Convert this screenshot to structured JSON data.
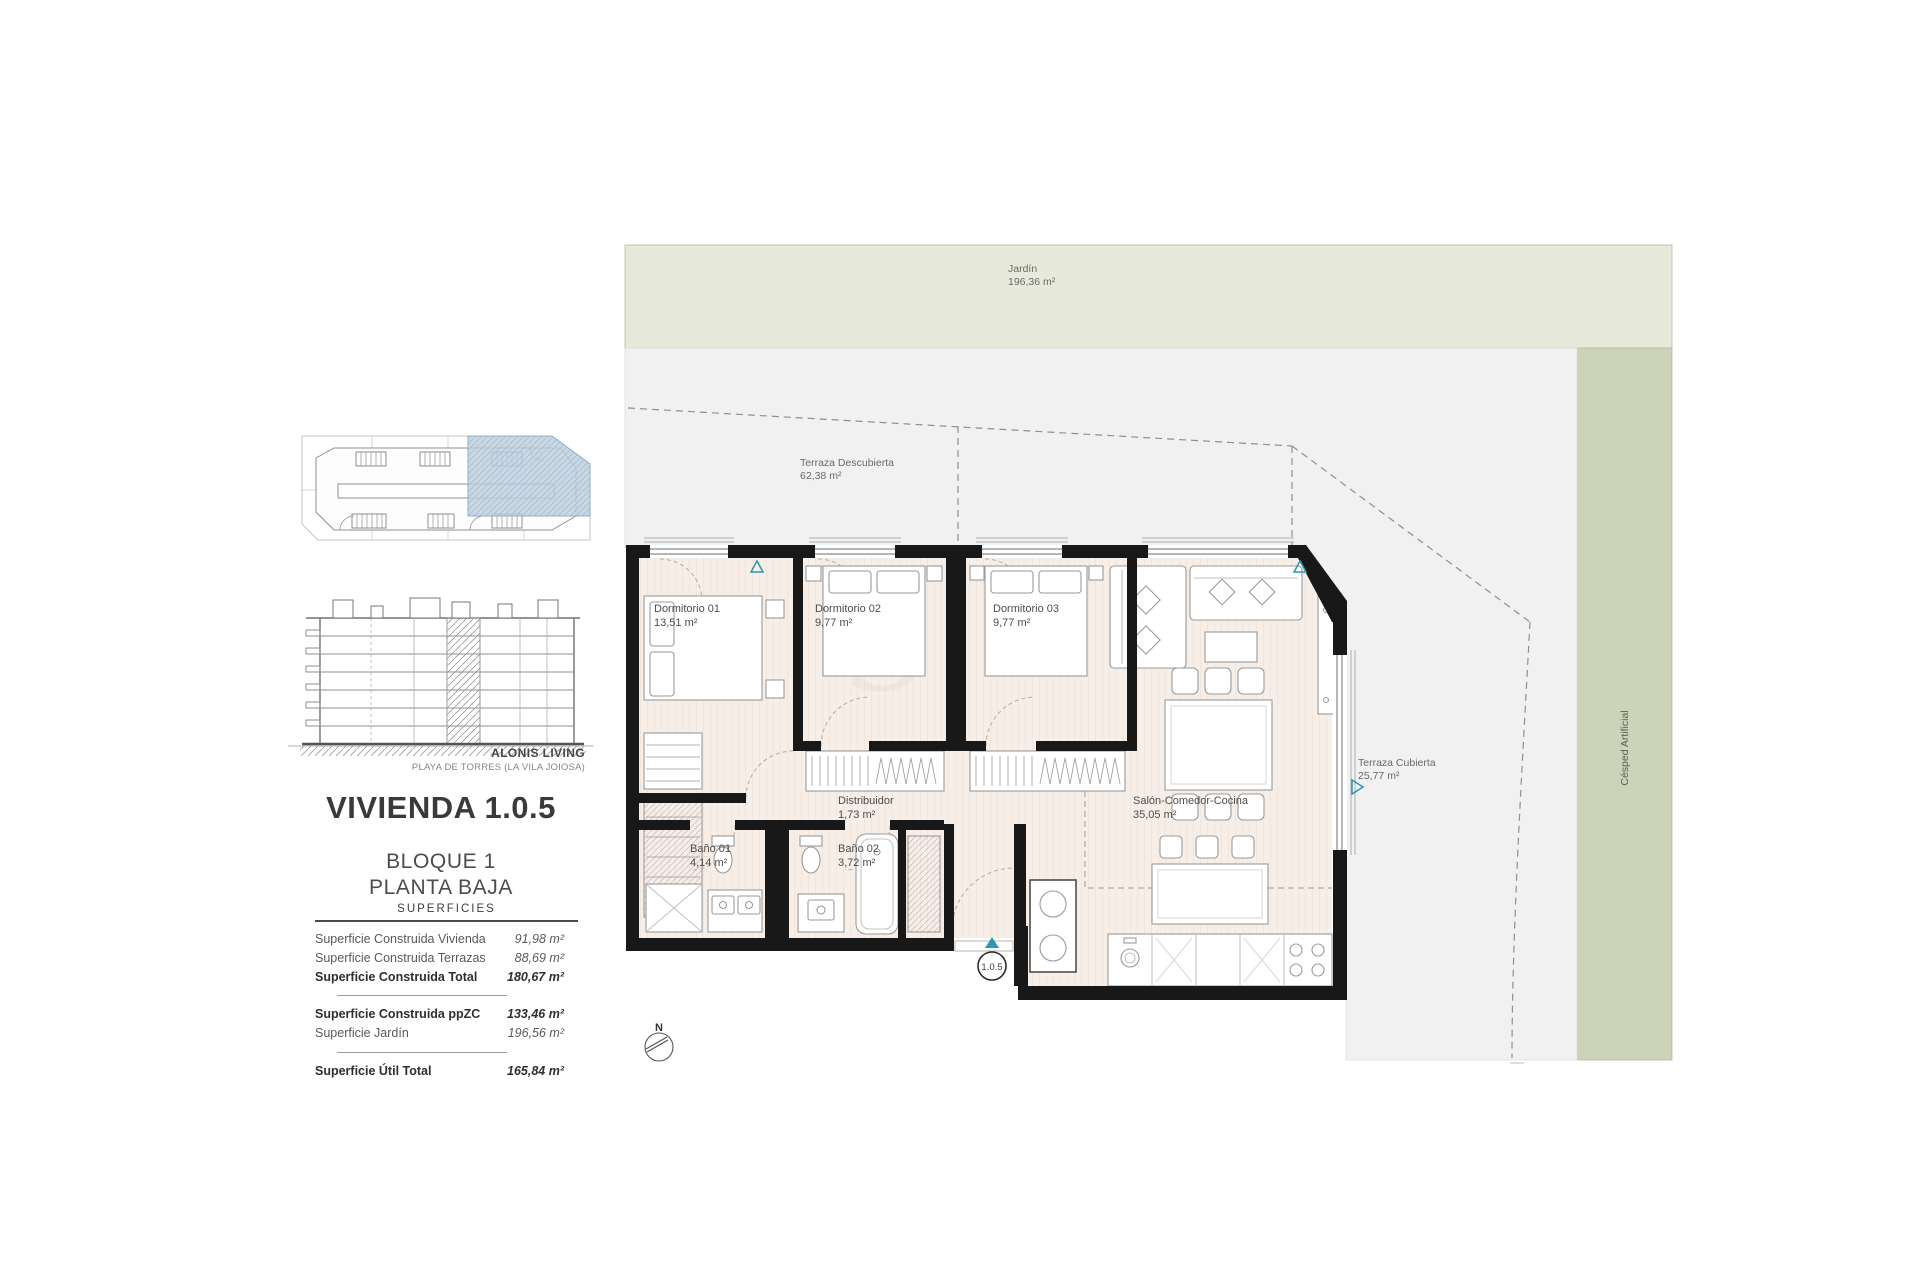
{
  "header": {
    "brand": "ALONIS LIVING",
    "location": "PLAYA DE TORRES (LA VILA JOIOSA)",
    "unit_title": "VIVIENDA 1.0.5",
    "block": "BLOQUE 1",
    "floor": "PLANTA BAJA"
  },
  "surfaces": {
    "title": "SUPERFICIES",
    "rows": [
      {
        "label": "Superficie Construida Vivienda",
        "value": "91,98 m²"
      },
      {
        "label": "Superficie Construida Terrazas",
        "value": "88,69 m²"
      },
      {
        "label": "Superficie Construida Total",
        "value": "180,67 m²"
      },
      {
        "label": "Superficie Construida ppZC",
        "value": "133,46 m²"
      },
      {
        "label": "Superficie Jardín",
        "value": "196,56 m²"
      },
      {
        "label": "Superficie Útil Total",
        "value": "165,84 m²"
      }
    ]
  },
  "plan": {
    "unit_badge": "1.0.5",
    "compass": "N",
    "rooms": [
      {
        "name": "Dormitorio 01",
        "area": "13,51 m²"
      },
      {
        "name": "Dormitorio 02",
        "area": "9,77 m²"
      },
      {
        "name": "Dormitorio 03",
        "area": "9,77 m²"
      },
      {
        "name": "Distribuidor",
        "area": "1,73 m²"
      },
      {
        "name": "Salón-Comedor-Cocina",
        "area": "35,05 m²"
      },
      {
        "name": "Baño 01",
        "area": "4,14 m²"
      },
      {
        "name": "Baño 02",
        "area": "3,72 m²"
      }
    ],
    "outdoor": [
      {
        "name": "Jardín",
        "area": "196,36 m²"
      },
      {
        "name": "Terraza Descubierta",
        "area": "62,38 m²"
      },
      {
        "name": "Terraza Cubierta",
        "area": "25,77 m²"
      },
      {
        "name": "Césped Artificial",
        "area": ""
      }
    ]
  },
  "colors": {
    "garden": "#e7eadb",
    "artificial_grass": "#ccd3b9",
    "terrace": "#f1f1f1",
    "floor": "#f8eee8",
    "wall": "#181818",
    "accent": "#2e97ac",
    "key_highlight": "#bed0e0"
  }
}
